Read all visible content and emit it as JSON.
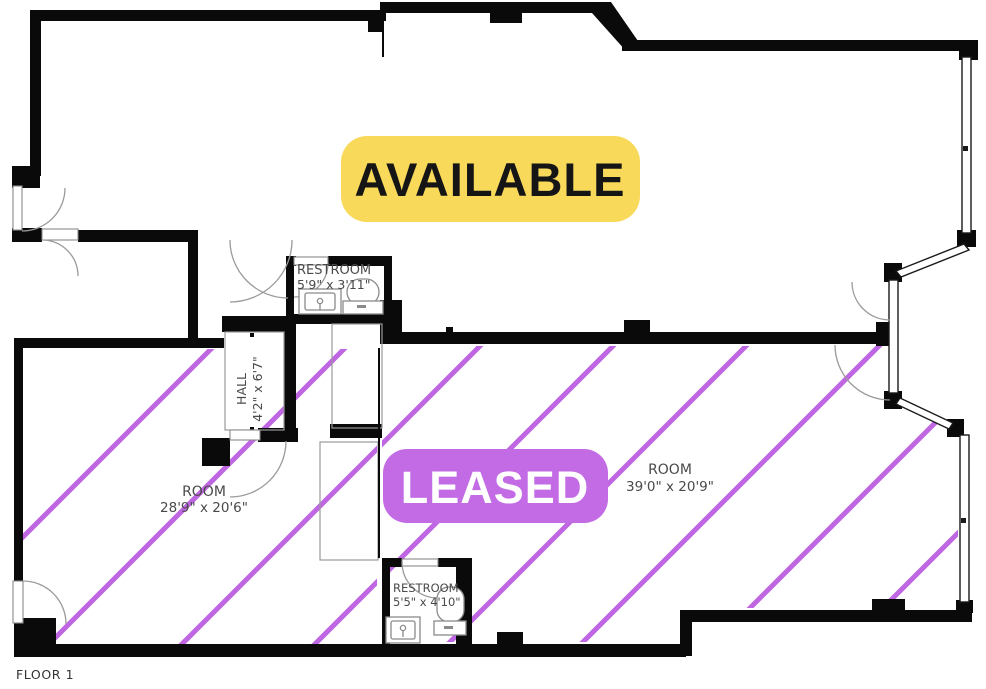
{
  "title": "Floor Plan",
  "floor": {
    "label": "FLOOR 1"
  },
  "status_badges": {
    "available": {
      "label": "AVAILABLE",
      "bg_color": "#F8D95A",
      "text_color": "#151515"
    },
    "leased": {
      "label": "LEASED",
      "bg_color": "#C36BE4",
      "text_color": "#FFFFFF"
    }
  },
  "rooms": {
    "restroom_upper": {
      "label": "RESTROOM",
      "dimensions": "5'9\" x 3'11\""
    },
    "hall": {
      "label": "HALL",
      "dimensions": "4'2\" x 6'7\""
    },
    "room_left": {
      "label": "ROOM",
      "dimensions": "28'9\" x 20'6\""
    },
    "room_right": {
      "label": "ROOM",
      "dimensions": "39'0\" x 20'9\""
    },
    "restroom_lower": {
      "label": "RESTROOM",
      "dimensions": "5'5\" x 4'10\""
    }
  },
  "colors": {
    "walls": "#0A0A0A",
    "hatch": "#BF66E3",
    "room_text": "#4A4A4A",
    "fixture_stroke": "#8A8A8A"
  }
}
